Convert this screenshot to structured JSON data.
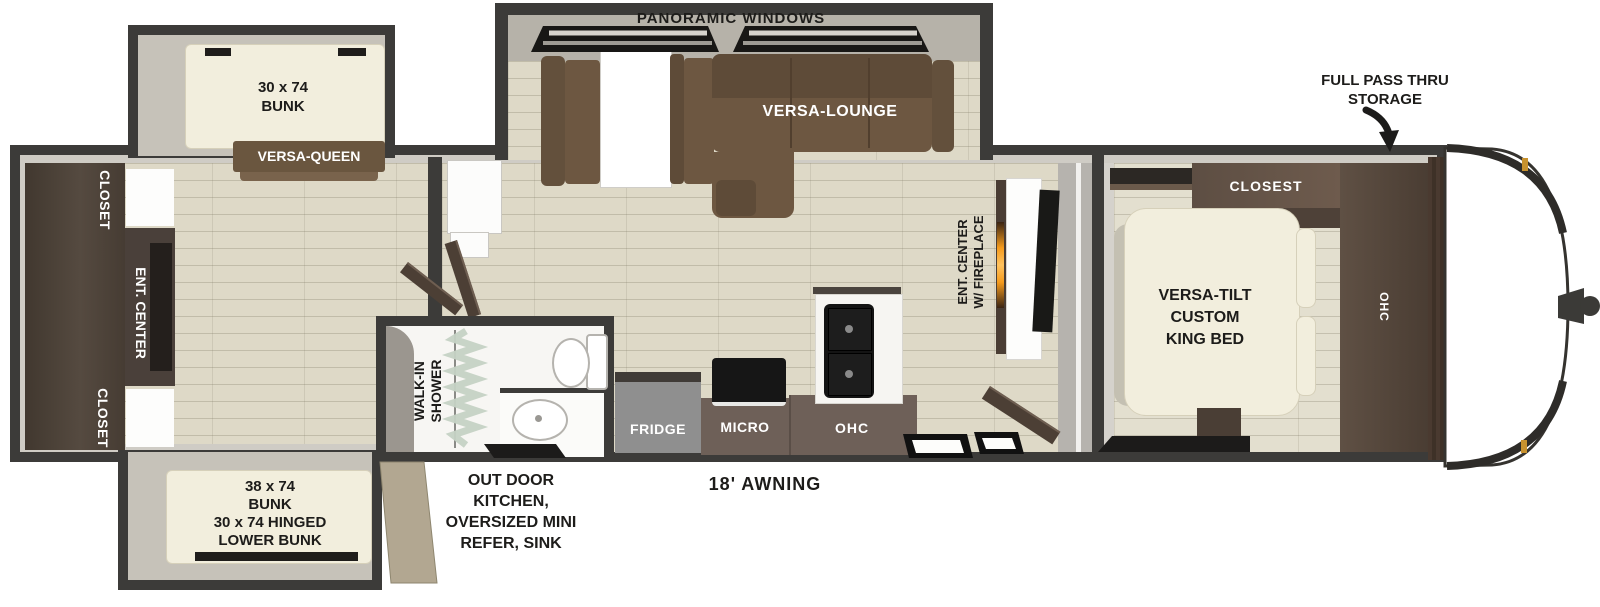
{
  "title": "RV travel trailer floor plan",
  "labels": {
    "panoramic_windows": "PANORAMIC WINDOWS",
    "versa_lounge": "VERSA-LOUNGE",
    "full_pass_thru_storage": {
      "line1": "FULL PASS THRU",
      "line2": "STORAGE"
    },
    "top_bunk": {
      "line1": "30 x 74",
      "line2": "BUNK"
    },
    "versa_queen": "VERSA-QUEEN",
    "closet_rear_top": "CLOSET",
    "ent_center_rear": "ENT. CENTER",
    "closet_rear_bottom": "CLOSET",
    "bottom_bunk": {
      "line1": "38 x 74",
      "line2": "BUNK",
      "line3": "30 x 74 HINGED",
      "line4": "LOWER BUNK"
    },
    "walk_in_shower": {
      "line1": "WALK-IN",
      "line2": "SHOWER"
    },
    "outdoor_kitchen": {
      "line1": "OUT DOOR",
      "line2": "KITCHEN,",
      "line3": "OVERSIZED MINI",
      "line4": "REFER, SINK"
    },
    "fridge": "FRIDGE",
    "micro": "MICRO",
    "ohc_kitchen": "OHC",
    "awning": "18' AWNING",
    "ent_center_fireplace": {
      "line1": "ENT. CENTER",
      "line2": "W/ FIREPLACE"
    },
    "king_bed": {
      "line1": "VERSA-TILT",
      "line2": "CUSTOM",
      "line3": "KING BED"
    },
    "closet_front": "CLOSEST",
    "ohc_bedroom": "OHC"
  },
  "colors": {
    "wall": "#3c3b39",
    "floor_plank": "#ded9c7",
    "slide_interior": "#c6c2b9",
    "dark_wood": "#4c423c",
    "sofa_brown": "#6d5741",
    "cabinet_brown": "#6e6058",
    "fridge_gray": "#8f8f8f",
    "bed_cream": "#f2eedd",
    "fireplace_orange": "#f59b1d",
    "curtain_green": "#c5d2c4",
    "marker_light_amber": "#c8922f"
  }
}
